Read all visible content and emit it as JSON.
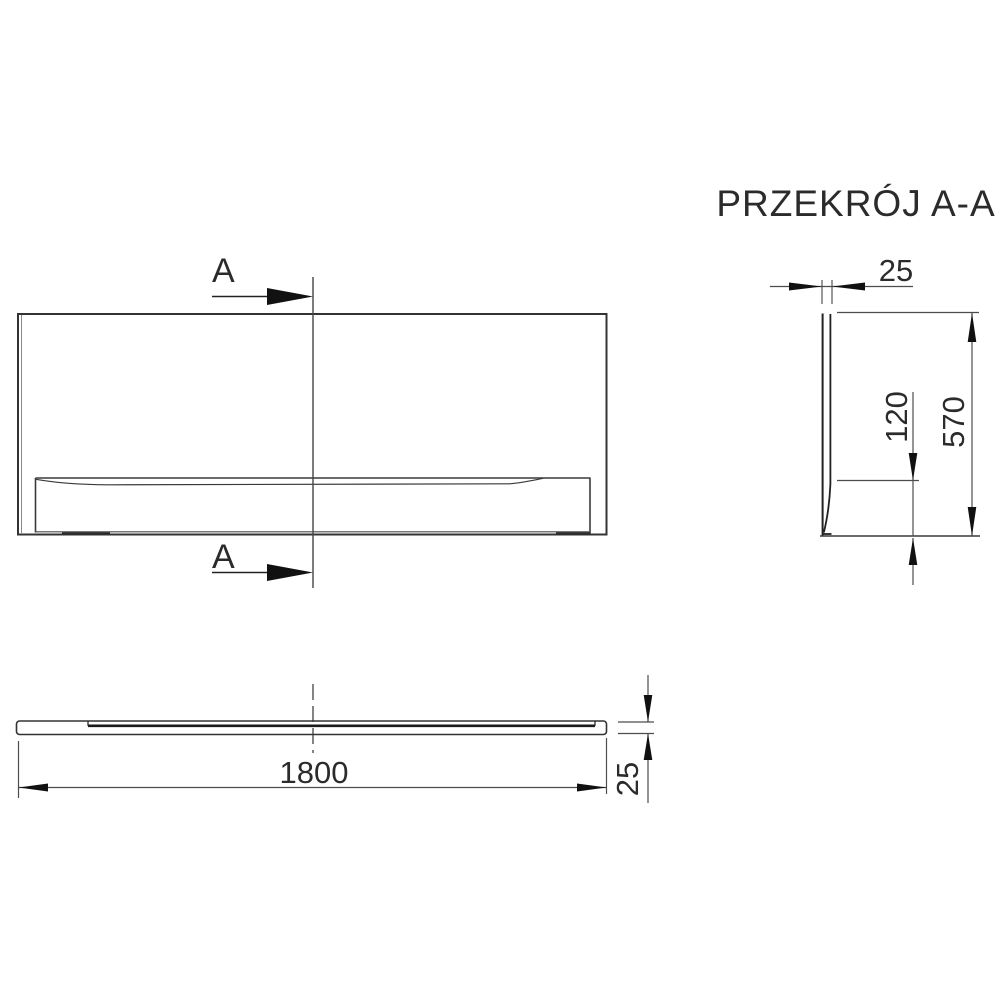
{
  "title": "PRZEKRÓJ A-A",
  "section_markers": {
    "top": "A",
    "bottom": "A"
  },
  "dimensions": {
    "panel_thickness_top": "25",
    "panel_height": "570",
    "bottom_recess_height": "120",
    "panel_length": "1800",
    "panel_thickness_plan": "25"
  },
  "colors": {
    "background": "#ffffff",
    "outline": "#333333",
    "dimension_line": "#4d4d4d",
    "text": "#2b2b2b",
    "arrow": "#111111"
  }
}
